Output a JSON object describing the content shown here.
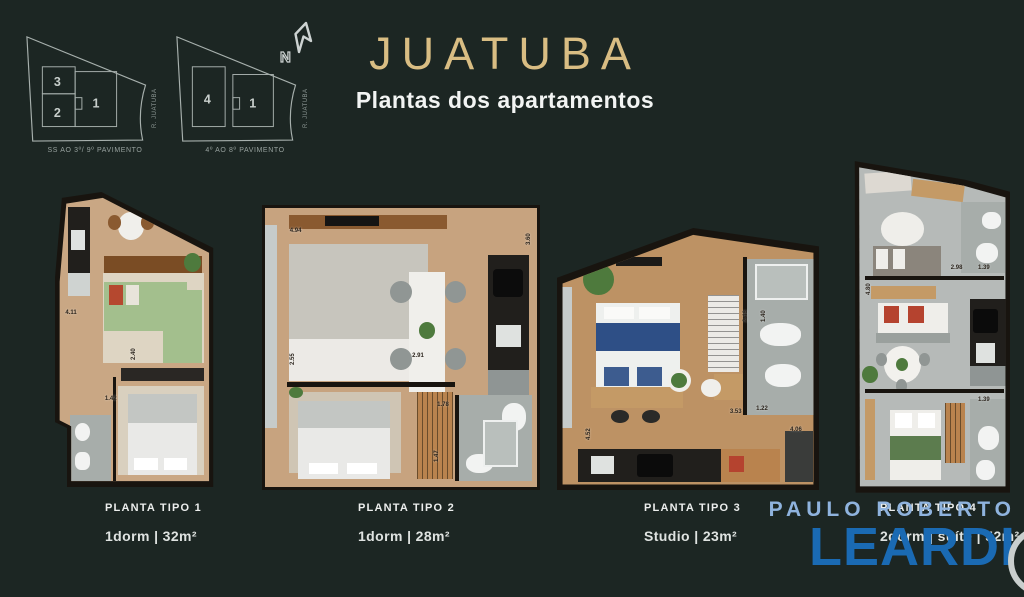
{
  "header": {
    "title": "JUATUBA",
    "subtitle": "Plantas dos apartamentos",
    "title_color": "#d9bd83"
  },
  "north": {
    "label": "N"
  },
  "keyplans": [
    {
      "caption": "SS AO 3º/ 9º PAVIMENTO",
      "street": "R. JUATUBA",
      "units": [
        {
          "label": "3"
        },
        {
          "label": "2"
        },
        {
          "label": "1"
        }
      ]
    },
    {
      "caption": "4º AO 8º PAVIMENTO",
      "street": "R. JUATUBA",
      "units": [
        {
          "label": "4"
        },
        {
          "label": "1"
        }
      ]
    }
  ],
  "plans": [
    {
      "name": "PLANTA TIPO 1",
      "spec": "1dorm | 32m²",
      "dims": [
        {
          "t": "4.11",
          "x": 6,
          "y": 40,
          "v": false
        },
        {
          "t": "2.40",
          "x": 44,
          "y": 57,
          "v": true
        },
        {
          "t": "1.42",
          "x": 29,
          "y": 69,
          "v": false
        }
      ]
    },
    {
      "name": "PLANTA TIPO 2",
      "spec": "1dorm | 28m²",
      "dims": [
        {
          "t": "4.94",
          "x": 10,
          "y": 8,
          "v": false
        },
        {
          "t": "3.60",
          "x": 95,
          "y": 14,
          "v": true
        },
        {
          "t": "2.55",
          "x": 10,
          "y": 56,
          "v": true
        },
        {
          "t": "2.91",
          "x": 54,
          "y": 52,
          "v": false
        },
        {
          "t": "1.78",
          "x": 63,
          "y": 69,
          "v": false
        },
        {
          "t": "1.47",
          "x": 62,
          "y": 90,
          "v": true
        }
      ]
    },
    {
      "name": "PLANTA TIPO 3",
      "spec": "Studio | 23m²",
      "dims": [
        {
          "t": "4.52",
          "x": 11,
          "y": 81,
          "v": true
        },
        {
          "t": "2.46",
          "x": 71,
          "y": 36,
          "v": true
        },
        {
          "t": "1.40",
          "x": 78,
          "y": 36,
          "v": true
        },
        {
          "t": "3.53",
          "x": 66,
          "y": 69,
          "v": false
        },
        {
          "t": "1.22",
          "x": 76,
          "y": 68,
          "v": false
        },
        {
          "t": "4.06",
          "x": 89,
          "y": 76,
          "v": false
        }
      ]
    },
    {
      "name": "PLANTA TIPO 4",
      "spec": "2dorm | suíte | 52m²",
      "dims": [
        {
          "t": "2.98",
          "x": 63,
          "y": 32,
          "v": false
        },
        {
          "t": "1.39",
          "x": 80,
          "y": 32,
          "v": false
        },
        {
          "t": "4.80",
          "x": 10,
          "y": 41,
          "v": true
        },
        {
          "t": "1.39",
          "x": 80,
          "y": 71,
          "v": false
        }
      ]
    }
  ],
  "watermark": {
    "line1": "PAULO ROBERTO",
    "line2": "LEARDI",
    "color1": "#8fb3de",
    "color2": "#1a6ab3"
  }
}
